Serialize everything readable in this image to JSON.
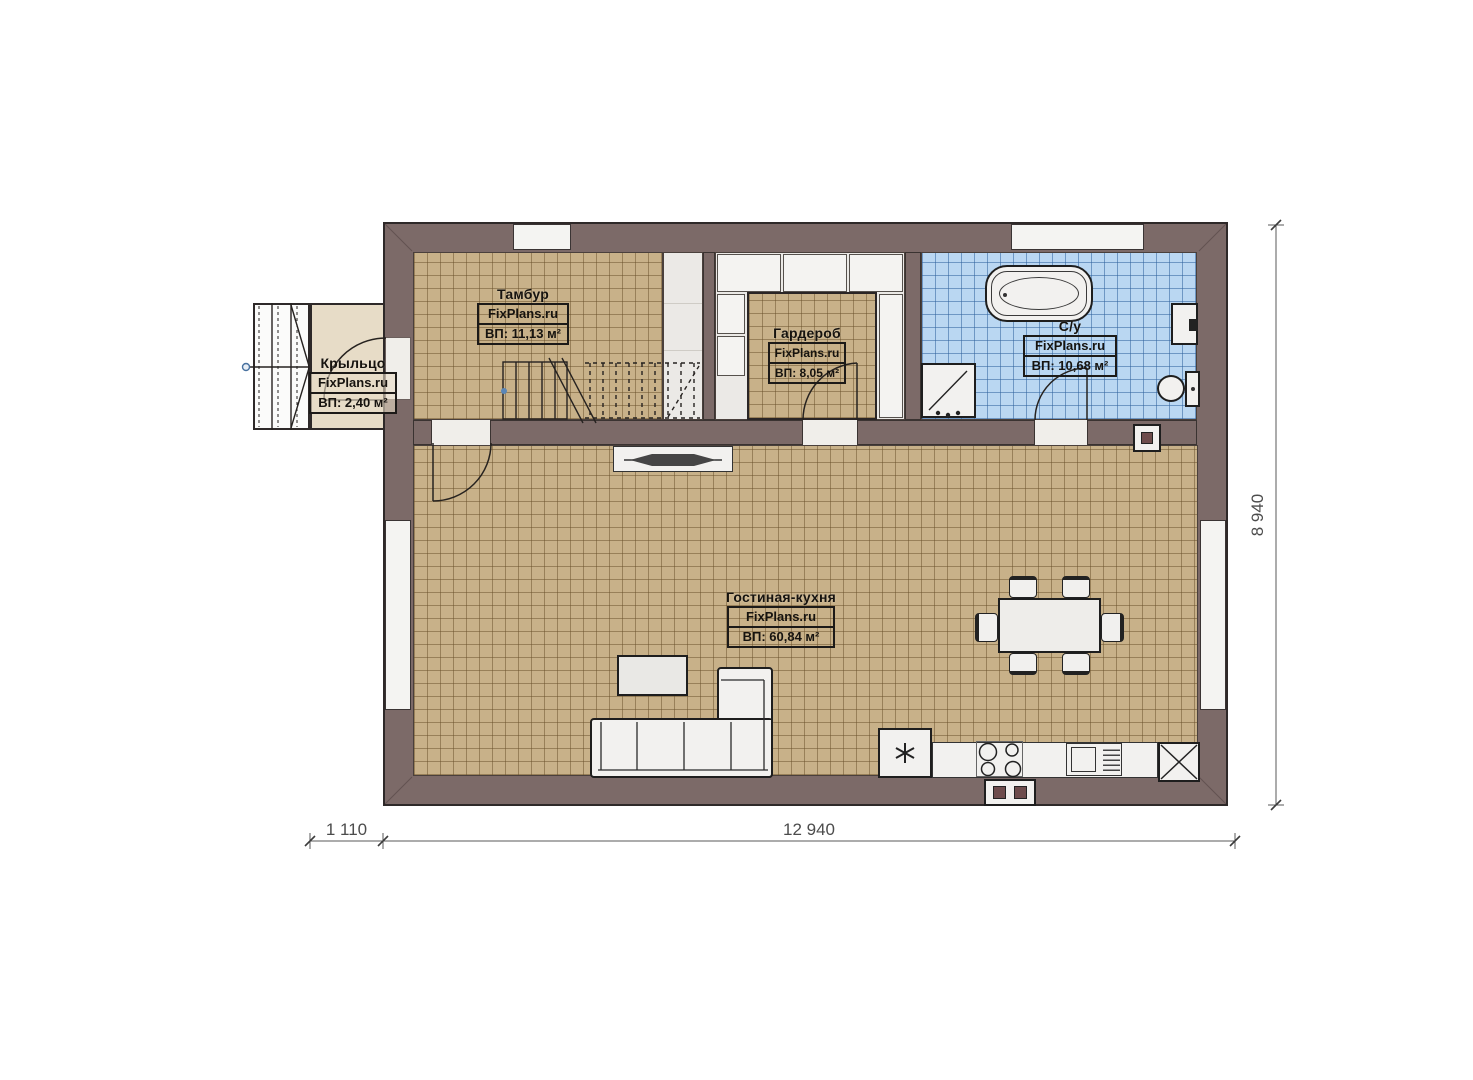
{
  "brand": "FixPlans.ru",
  "rooms": {
    "tambur": {
      "name": "Тамбур",
      "site": "FixPlans.ru",
      "area": "ВП: 11,13 м²"
    },
    "garderob": {
      "name": "Гардероб",
      "site": "FixPlans.ru",
      "area": "ВП: 8,05 м²"
    },
    "su": {
      "name": "С/у",
      "site": "FixPlans.ru",
      "area": "ВП: 10,68 м²"
    },
    "living": {
      "name": "Гостиная-кухня",
      "site": "FixPlans.ru",
      "area": "ВП: 60,84 м²"
    },
    "porch": {
      "name": "Крыльцо",
      "site": "FixPlans.ru",
      "area": "ВП: 2,40 м²"
    }
  },
  "dimensions": {
    "porch_depth": "1 110",
    "house_width": "12 940",
    "house_height": "8 940"
  },
  "colors": {
    "wall": "#7c6a68",
    "tile_tan": "#c8b189",
    "tile_blue": "#bad7f2",
    "porch_floor": "#e7dcc7",
    "corridor": "#ebe9e6"
  }
}
